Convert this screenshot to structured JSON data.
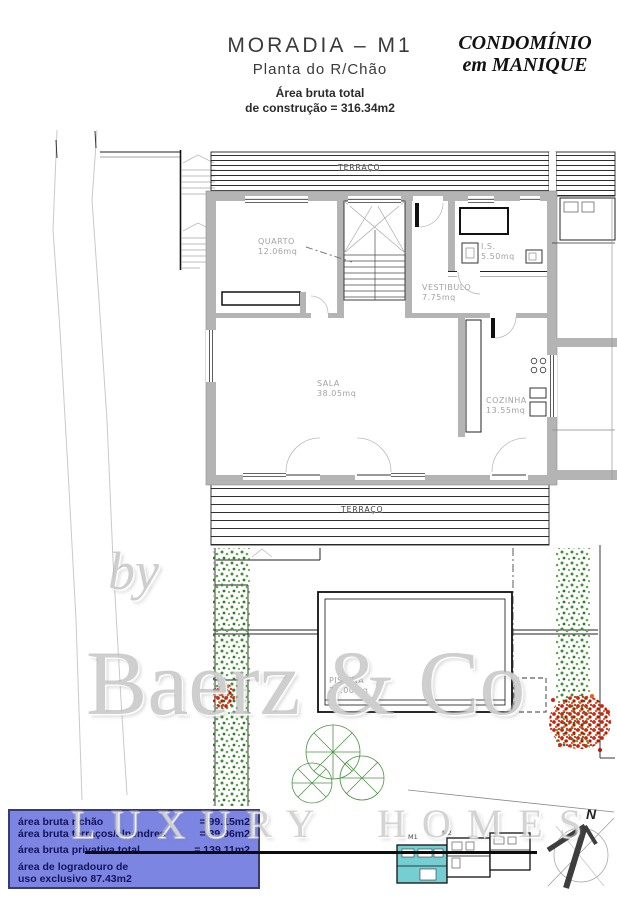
{
  "header": {
    "title": "MORADIA – M1",
    "subtitle": "Planta do R/Chão",
    "gross_area_line1": "Área bruta total",
    "gross_area_line2": "de construção = 316.34m2",
    "brand_line1": "CONDOMÍNIO",
    "brand_line2": "em MANIQUE"
  },
  "plan": {
    "terrace_top_label": "TERRAÇO",
    "terrace_bottom_label": "TERRAÇO",
    "rooms": {
      "quarto": {
        "name": "QUARTO",
        "area": "12.06mq"
      },
      "is": {
        "name": "I.S.",
        "area": "5.50mq"
      },
      "vestibulo": {
        "name": "VESTIBULO",
        "area": "7.75mq"
      },
      "sala": {
        "name": "SALA",
        "area": "38.05mq"
      },
      "cozinha": {
        "name": "COZINHA",
        "area": "13.55mq"
      },
      "piscina": {
        "name": "PISCINA",
        "area": "21.00mq"
      }
    }
  },
  "info_box": {
    "rows": [
      {
        "label": "área bruta r/chão",
        "value": "=  99.15m2"
      },
      {
        "label": "área bruta terraços/alpendres",
        "value": "=  39.96m2"
      },
      {
        "label": "área bruta privativa total",
        "value": "= 139.11m2"
      }
    ],
    "note_line1": "área de logradouro de",
    "note_line2": "uso exclusivo 87.43m2"
  },
  "site_plan": {
    "unit1": "M1",
    "unit2": "M2",
    "north": "N"
  },
  "watermark": {
    "prefix": "by",
    "brand": "Baerz & Co",
    "tagline": "LUXURY HOMES"
  },
  "colors": {
    "wall": "#b4b4b4",
    "info-bg": "#7c86e2",
    "info-border": "#3a3a72",
    "info-text": "#13135a",
    "highlight": "#74ced2",
    "hedge": "#3f8f3b",
    "flower": "#d42410",
    "watermark": "#acacac"
  }
}
